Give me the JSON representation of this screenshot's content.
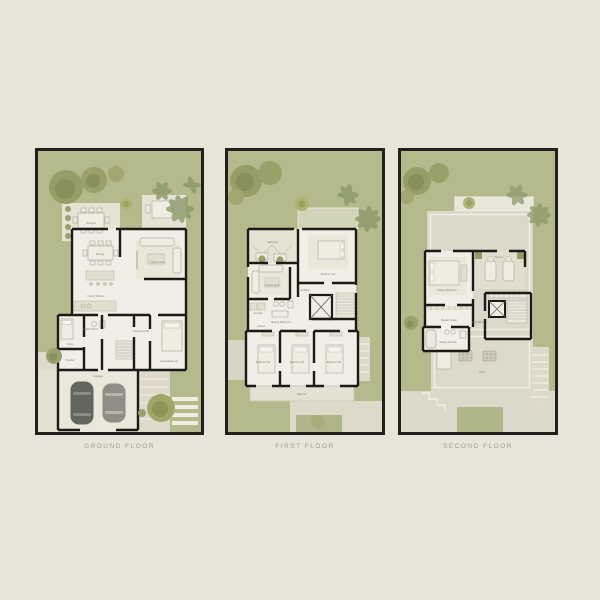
{
  "page": {
    "background": "#e8e4da",
    "grass": "#b5ba8d",
    "panel_border": "#22201b",
    "floor_fill": "#f0eee7",
    "hardscape": "#ded9c9",
    "wall_color": "#1b1a17",
    "tree_color": "#959b65",
    "caption_color": "#a29c8e"
  },
  "floors": [
    {
      "caption": "GROUND FLOOR",
      "rooms": {
        "terrace": "Terrace",
        "dining": "Dining",
        "family_living": "Family Living",
        "family_kitchen": "Family Kitchen",
        "maids_room": "Maid's Room",
        "store": "Store",
        "powder": "Powder",
        "entrance_hall": "Entrance Hall",
        "guest_bedroom": "Guest Bedroom",
        "garage": "Garage"
      }
    },
    {
      "caption": "FIRST FLOOR",
      "rooms": {
        "balcony_front": "Balcony",
        "bedroom_02": "Bedroom 02",
        "family_room": "Family Room",
        "laundry": "Laundry",
        "shared_bathroom": "Shared Bathroom",
        "closet": "Closet",
        "circulation": "Circulation",
        "bedroom_03": "Bedroom 03",
        "bedroom_04": "Bedroom 04",
        "bedroom_05": "Bedroom 05",
        "balcony_rear": "Balcony"
      }
    },
    {
      "caption": "SECOND FLOOR",
      "rooms": {
        "master_bedroom": "Master Bedroom",
        "terrace": "Terrace",
        "master_closet": "Master Closet",
        "master_ensuite": "Master Ensuite",
        "circulation": "Circulation",
        "roof": "Roof"
      }
    }
  ]
}
